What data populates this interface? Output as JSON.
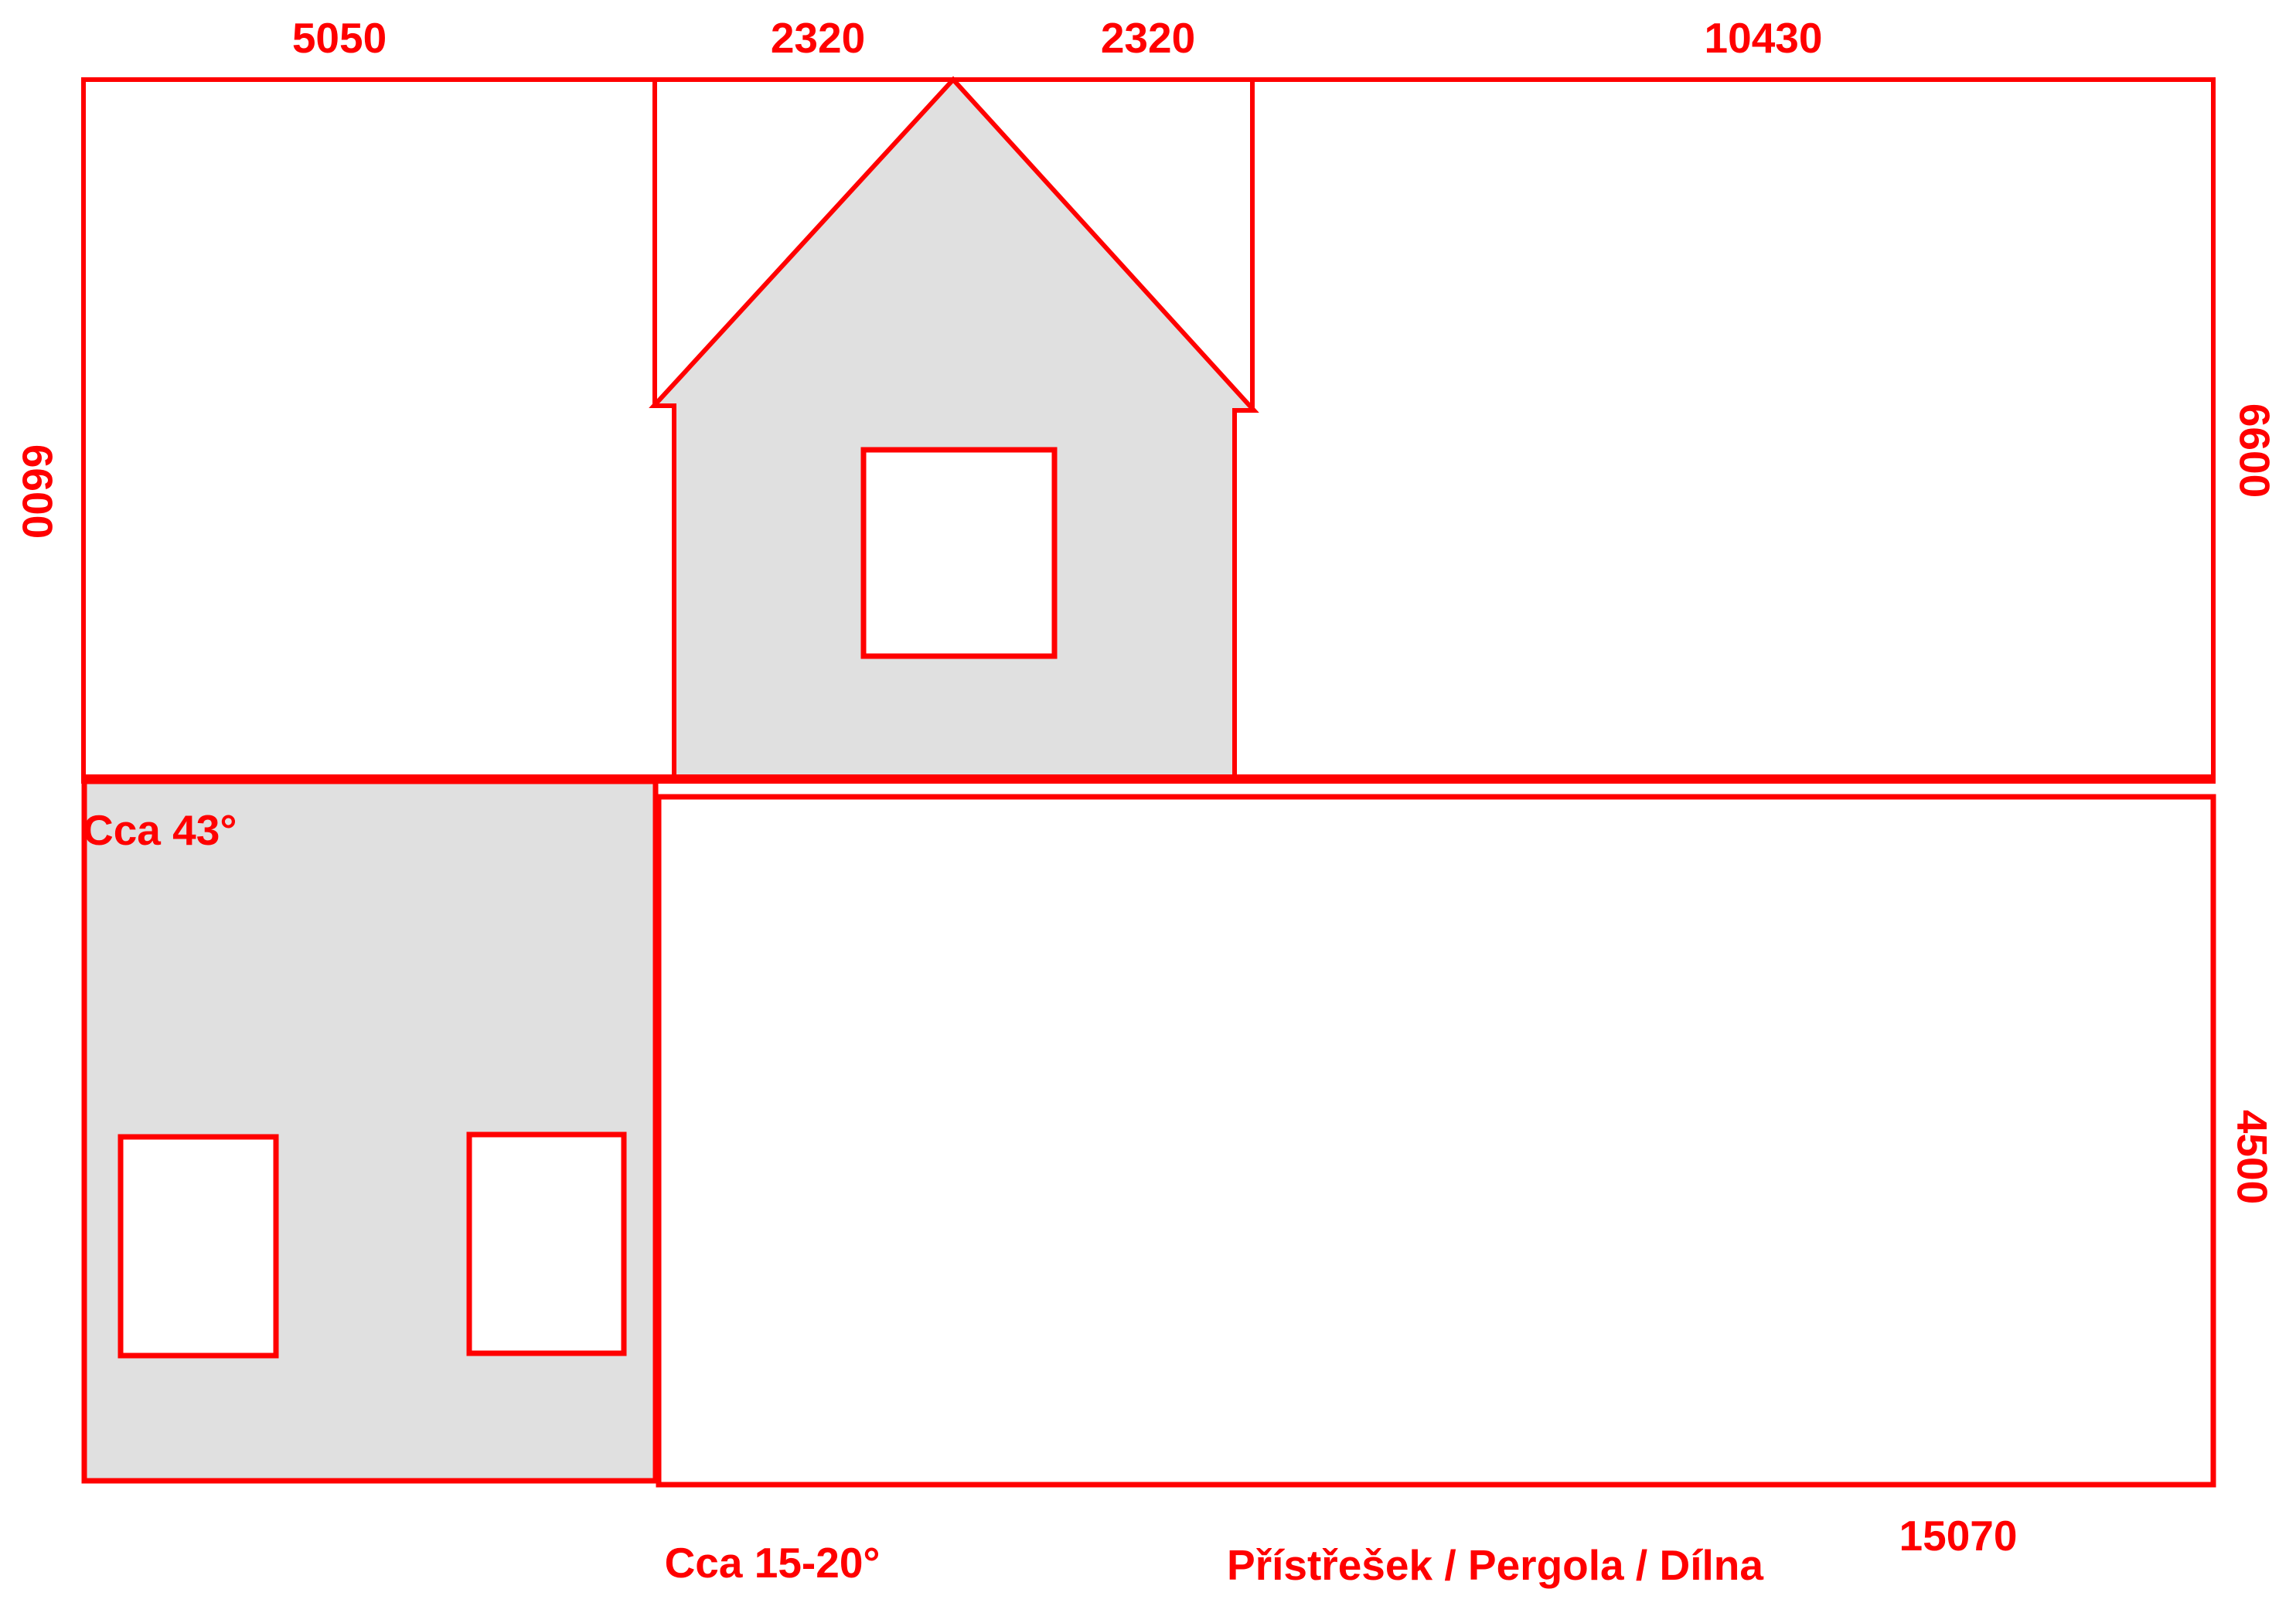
{
  "drawing_title": "House elevation and shed sketch",
  "colors": {
    "line": "#FF0000",
    "label": "#FF0000",
    "wall_fill": "#E0E0E0",
    "background": "#FFFFFF"
  },
  "dimensions": {
    "top_widths": [
      "5050",
      "2320",
      "2320",
      "10430"
    ],
    "left_height": "6600",
    "right_height_upper": "6600",
    "right_height_lower": "4500",
    "bottom_width": "15070"
  },
  "annotations": {
    "roof_angle": "Cca 43°",
    "shed_roof_angle": "Cca 15-20°",
    "shed_label": "Přístřešek / Pergola / Dílna"
  }
}
